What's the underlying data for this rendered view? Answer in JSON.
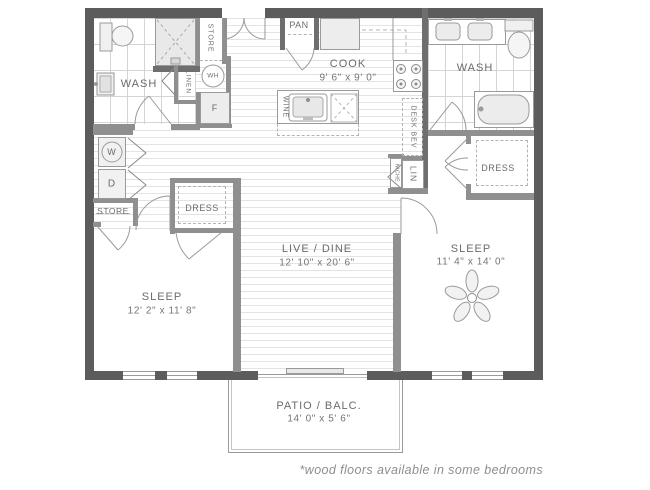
{
  "page": {
    "footnote": "*wood floors available in some bedrooms"
  },
  "rooms": {
    "wash_left": {
      "label": "WASH"
    },
    "wash_right": {
      "label": "WASH"
    },
    "cook": {
      "label": "COOK",
      "dims": "9' 6\" x 9' 0\""
    },
    "live_dine": {
      "label": "LIVE / DINE",
      "dims": "12' 10\" x 20' 6\""
    },
    "sleep_left": {
      "label": "SLEEP",
      "dims": "12' 2\" x 11' 8\""
    },
    "sleep_right": {
      "label": "SLEEP",
      "dims": "11' 4\" x 14' 0\""
    },
    "patio": {
      "label": "PATIO / BALC.",
      "dims": "14' 0\" x 5' 6\""
    }
  },
  "closets": {
    "store_top": {
      "label": "STORE"
    },
    "store_left": {
      "label": "STORE"
    },
    "linen": {
      "label": "LINEN"
    },
    "dress_left": {
      "label": "DRESS"
    },
    "dress_right": {
      "label": "DRESS"
    },
    "pantry": {
      "label": "PAN"
    },
    "lin": {
      "label": "LIN"
    },
    "niche": {
      "label": "NICHE"
    },
    "desk_bev": {
      "label": "DESK BEV"
    },
    "wine": {
      "label": "WINE"
    }
  },
  "appliances": {
    "water_heater": {
      "label": "WH"
    },
    "fridge": {
      "label": "F"
    },
    "washer": {
      "label": "W"
    },
    "dryer": {
      "label": "D"
    }
  },
  "colors": {
    "exterior_wall": "#5c5c5c",
    "partition_wall": "#8f8f8f",
    "fixture_line": "#9a9a9a",
    "label_text": "#6b6b6b",
    "dim_text": "#757575",
    "floor_line": "#e3e3e3"
  }
}
